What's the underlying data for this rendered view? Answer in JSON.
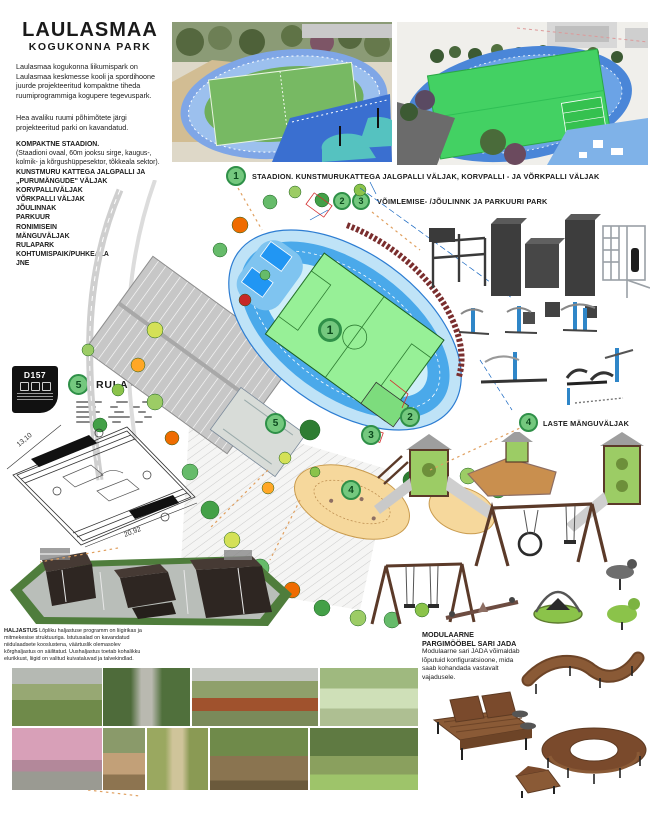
{
  "header": {
    "title": "LAULASMAA",
    "subtitle": "KOGUKONNA PARK"
  },
  "intro": {
    "p1": "Laulasmaa kogukonna liikumispark on Laulasmaa keskmesse kooli ja spordihoone juurde projekteeritud kompaktne tiheda ruumiprogrammiga kogupere tegevuspark.",
    "p2": "Hea avaliku ruumi põhimõtete järgi projekteeritud parki on kavandatud."
  },
  "features": {
    "items": [
      "KOMPAKTNE STAADION.",
      "(Staadioni ovaal, 60m jooksu sirge, kaugus-, kolmik- ja kõrgushüppesektor, tõkkeala sektor).",
      "KUNSTMURU KATTEGA JALGPALLI JA „PURUMÄNGUDE\" VÄLJAK",
      "KORVPALLIVÄLJAK",
      "VÕRKPALLI VÄLJAK",
      "JÕULINNAK",
      "PARKUUR",
      "RONIMISEIN",
      "MÄNGUVÄLJAK",
      "RULAPARK",
      "KOHTUMISPAIK/PUHKEALA",
      "JNE"
    ]
  },
  "callouts": {
    "one": {
      "number": "1",
      "label": "STAADION. KUNSTMURUKATTEGA JALGPALLI VÄLJAK, KORVPALLI - JA VÕRKPALLI VÄLJAK"
    },
    "twothree": {
      "number_a": "2",
      "number_b": "3",
      "label": "VÕIMLEMISE- /JÕULINNK JA PARKUURI PARK"
    },
    "four": {
      "number": "4",
      "label": "LASTE MÄNGUVÄLJAK"
    },
    "five": {
      "number": "5",
      "label": "RULAPARK"
    }
  },
  "badge": {
    "code": "D157"
  },
  "plan": {
    "markers": {
      "m1": "1",
      "m2": "2",
      "m3": "3",
      "m4": "4",
      "m5": "5"
    }
  },
  "skatepark_drawing": {
    "dim_a": "13,10",
    "dim_b": "20,92"
  },
  "landscape_note": {
    "heading": "HALJASTUS",
    "body": "Lõpliku haljastuse programm on liigirikas ja mitmekesise struktuuriga. Istutusalad on kavandatud niidulaadsete kooslustena, väärtuslik olemasolev kõrghaljastus on säilitatud. Uushaljastus toetab kohalikku elurikkust, liigid on valitud kuivataluvad ja talvekindlad."
  },
  "furniture": {
    "heading": "MODULAARNE PARGIMÖÖBEL SARI JADA",
    "body": "Modulaarne sari JADA võimaldab lõputuid konfiguratsioone, mida saab kohandada vastavalt vajadusele."
  },
  "colors": {
    "accent_green": "#74c87e",
    "accent_green_dark": "#2f9048",
    "track_blue": "#4aa9ea",
    "field_green": "#97f097",
    "sand": "#f6d89c"
  }
}
